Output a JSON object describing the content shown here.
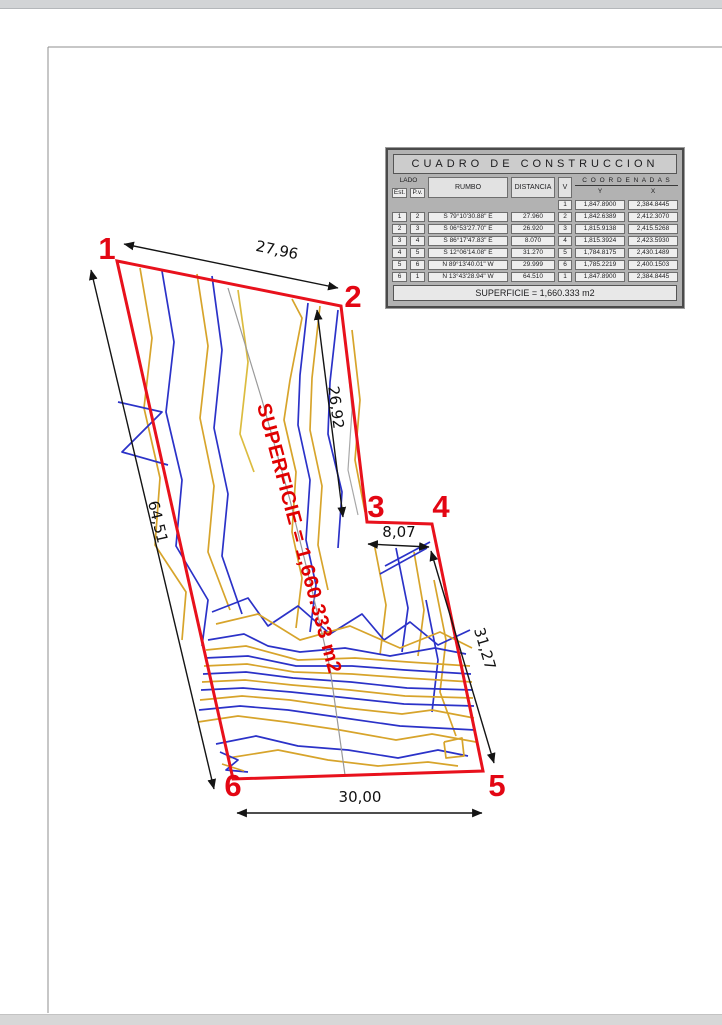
{
  "drawing": {
    "vertex_labels": [
      "1",
      "2",
      "3",
      "4",
      "5",
      "6"
    ],
    "dimensions": {
      "side_1_2": "27,96",
      "side_2_3": "26,92",
      "side_3_4": "8,07",
      "side_4_5": "31,27",
      "side_5_6": "30,00",
      "side_6_1": "64,51"
    },
    "area_label": "SUPERFICIE = 1,660.333 m2",
    "colors": {
      "boundary_red": "#e8111c",
      "vertex_red": "#e30613",
      "contour_blue": "#2b32c8",
      "contour_orange": "#d7a42b",
      "centerline_gray": "#9a9a9a",
      "dimension_black": "#141414"
    }
  },
  "table": {
    "title": "CUADRO DE CONSTRUCCION",
    "headers": {
      "lado": "LADO",
      "est": "Est.",
      "pv": "P.v.",
      "rumbo": "RUMBO",
      "distancia": "DISTANCIA",
      "v": "V",
      "coordenadas": "C O O R D E N A D A S",
      "y": "Y",
      "x": "X"
    },
    "first_row": {
      "v": "1",
      "y": "1,847.8900",
      "x": "2,384.8445"
    },
    "rows": [
      {
        "est": "1",
        "pv": "2",
        "rumbo": "S 79°10'30.88\" E",
        "distancia": "27.960",
        "v": "2",
        "y": "1,842.6389",
        "x": "2,412.3070"
      },
      {
        "est": "2",
        "pv": "3",
        "rumbo": "S 06°53'27.70\" E",
        "distancia": "26.920",
        "v": "3",
        "y": "1,815.9138",
        "x": "2,415.5268"
      },
      {
        "est": "3",
        "pv": "4",
        "rumbo": "S 86°17'47.83\" E",
        "distancia": "8.070",
        "v": "4",
        "y": "1,815.3924",
        "x": "2,423.5930"
      },
      {
        "est": "4",
        "pv": "5",
        "rumbo": "S 12°06'14.08\" E",
        "distancia": "31.270",
        "v": "5",
        "y": "1,784.8175",
        "x": "2,430.1489"
      },
      {
        "est": "5",
        "pv": "6",
        "rumbo": "N 89°13'40.01\" W",
        "distancia": "29.999",
        "v": "6",
        "y": "1,785.2219",
        "x": "2,400.1503"
      },
      {
        "est": "6",
        "pv": "1",
        "rumbo": "N 13°43'28.94\" W",
        "distancia": "64.510",
        "v": "1",
        "y": "1,847.8900",
        "x": "2,384.8445"
      }
    ],
    "superficie": "SUPERFICIE  =  1,660.333  m2"
  }
}
